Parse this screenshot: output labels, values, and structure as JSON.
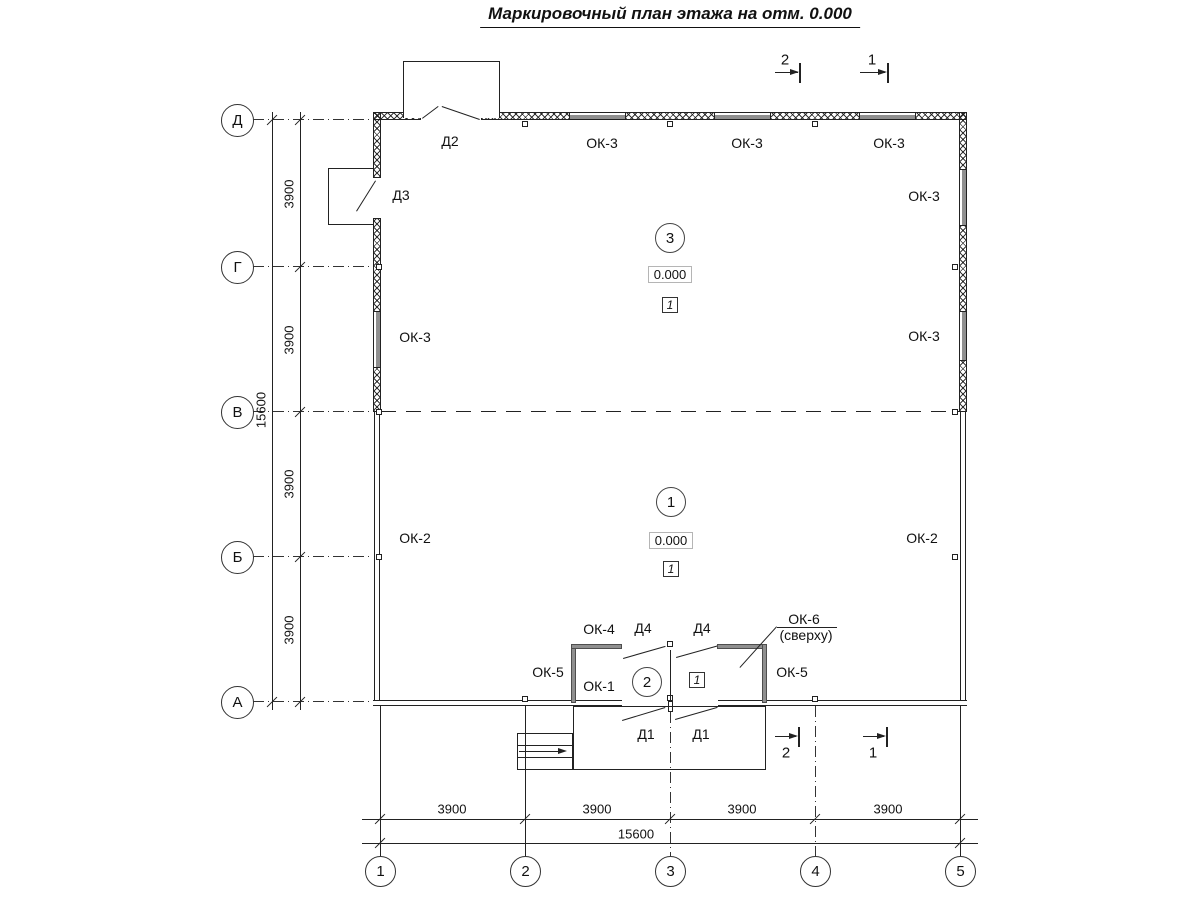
{
  "title": "Маркировочный план этажа на отм. 0.000",
  "axes": {
    "rows": [
      "Д",
      "Г",
      "В",
      "Б",
      "А"
    ],
    "cols": [
      "1",
      "2",
      "3",
      "4",
      "5"
    ]
  },
  "dims": {
    "segment": "3900",
    "total": "15600"
  },
  "sections": {
    "s1": "1",
    "s2": "2"
  },
  "rooms": {
    "r3": {
      "num": "3",
      "elev": "0.000",
      "fin": "1"
    },
    "r1": {
      "num": "1",
      "elev": "0.000",
      "fin": "1"
    },
    "r2": {
      "num": "2",
      "fin": "1"
    }
  },
  "marks": {
    "ok1": "ОК-1",
    "ok2": "ОК-2",
    "ok3": "ОК-3",
    "ok4": "ОК-4",
    "ok5": "ОК-5",
    "ok6": "ОК-6",
    "ok6note": "(сверху)",
    "d1": "Д1",
    "d2": "Д2",
    "d3": "Д3",
    "d4": "Д4"
  }
}
